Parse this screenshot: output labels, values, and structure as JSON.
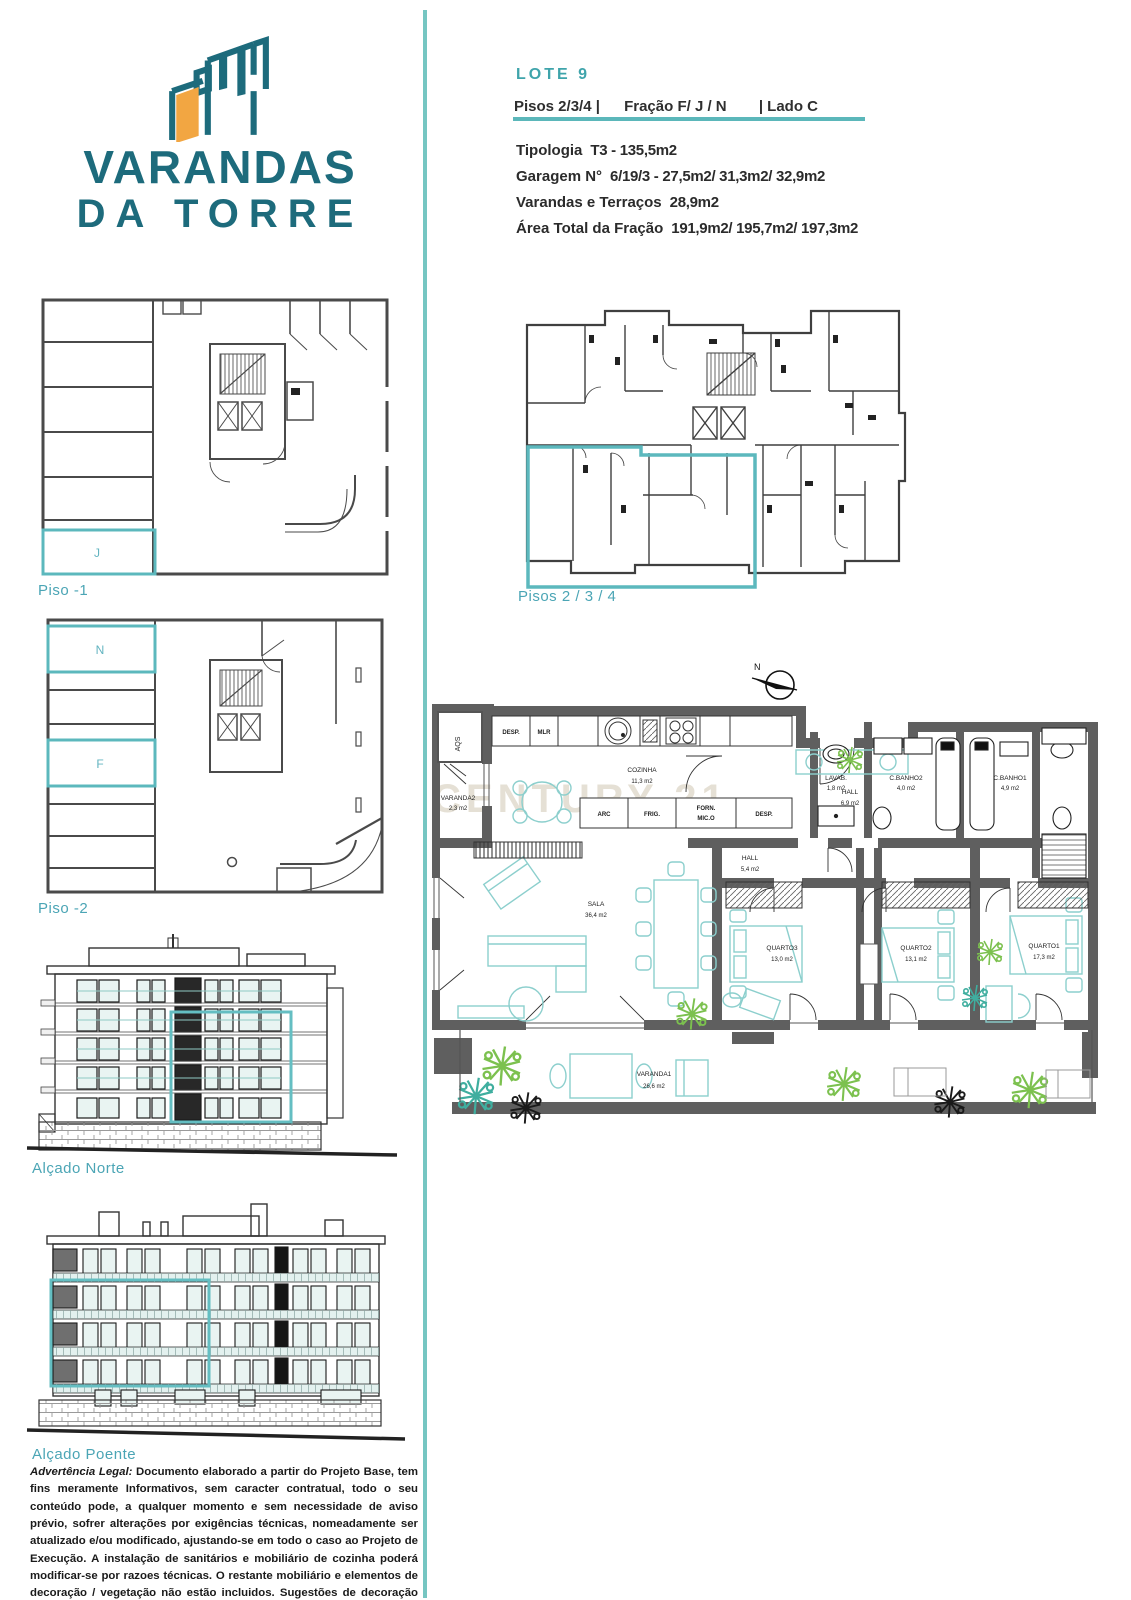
{
  "logo": {
    "line1": "VARANDAS",
    "line2": "DA TORRE"
  },
  "colors": {
    "teal_brand": "#1d6b7c",
    "orange": "#f2a642",
    "accent": "#5bb7ba",
    "highlight": "#5cb8bd",
    "label_teal": "#4ba5b5",
    "wall_gray": "#5f5f5f",
    "furniture_teal": "#8ccfcd",
    "plant_green": "#7cc14f",
    "watermark_color": "#d8d0bf"
  },
  "header": {
    "lote": "LOTE 9",
    "pisos": "Pisos 2/3/4 |",
    "fracao": "Fração F/ J / N",
    "lado": "| Lado C",
    "details": [
      {
        "label": "Tipologia",
        "value": "T3 - 135,5m2"
      },
      {
        "label": "Garagem N°",
        "value": "6/19/3 - 27,5m2/ 31,3m2/ 32,9m2"
      },
      {
        "label": "Varandas e Terraços",
        "value": "28,9m2"
      },
      {
        "label": "Área Total da Fração",
        "value": "191,9m2/ 195,7m2/ 197,3m2"
      }
    ]
  },
  "plans": {
    "piso_minus_1": {
      "label": "Piso -1",
      "highlight": "J"
    },
    "piso_minus_2": {
      "label": "Piso -2",
      "highlight_top": "N",
      "highlight_mid": "F"
    },
    "alcado_norte": {
      "label": "Alçado Norte"
    },
    "alcado_poente": {
      "label": "Alçado Poente"
    },
    "pisos_234": {
      "label": "Pisos 2 / 3 / 4"
    }
  },
  "apartment": {
    "north": "N",
    "watermark": "CENTURY 21",
    "corner_label": "AQS",
    "rooms": {
      "varanda2": {
        "name": "VARANDA2",
        "area": "2,3 m2"
      },
      "cozinha": {
        "name": "COZINHA",
        "area": "11,3 m2"
      },
      "hall": {
        "name": "HALL",
        "area": "6,9 m2"
      },
      "lavab": {
        "name": "LAVAB.",
        "area": "1,8 m2"
      },
      "cbanho2": {
        "name": "C.BANHO2",
        "area": "4,0 m2"
      },
      "cbanho1": {
        "name": "C.BANHO1",
        "area": "4,9 m2"
      },
      "hall2": {
        "name": "HALL",
        "area": "5,4 m2"
      },
      "sala": {
        "name": "SALA",
        "area": "36,4 m2"
      },
      "quarto3": {
        "name": "QUARTO3",
        "area": "13,0 m2"
      },
      "quarto2": {
        "name": "QUARTO2",
        "area": "13,1 m2"
      },
      "quarto1": {
        "name": "QUARTO1",
        "area": "17,3 m2"
      },
      "varanda1": {
        "name": "VARANDA1",
        "area": "26,6 m2"
      }
    },
    "kitchen": {
      "desp_top": "DESP.",
      "mlr": "MLR",
      "arc": "ARC",
      "frig": "FRIG.",
      "forn": "FORN.",
      "mico": "MIC.O",
      "desp_bottom": "DESP."
    }
  },
  "legal": {
    "lead": "Advertência Legal:",
    "body": " Documento elaborado a partir do Projeto Base, tem fins meramente Informativos, sem caracter contratual, todo o seu conteúdo pode, a qualquer momento e sem necessidade de aviso prévio, sofrer alterações por exigências técnicas, nomeadamente ser atualizado e/ou modificado, ajustando-se em todo o caso ao Projeto de Execução. A instalação de sanitários e mobiliário de cozinha poderá modificar-se por razoes técnicas. O restante mobiliário e elementos de decoração / vegetação não estão incluidos. Sugestões de decoração em caso de incluir, não é necessariamente conforme as imagens."
  }
}
